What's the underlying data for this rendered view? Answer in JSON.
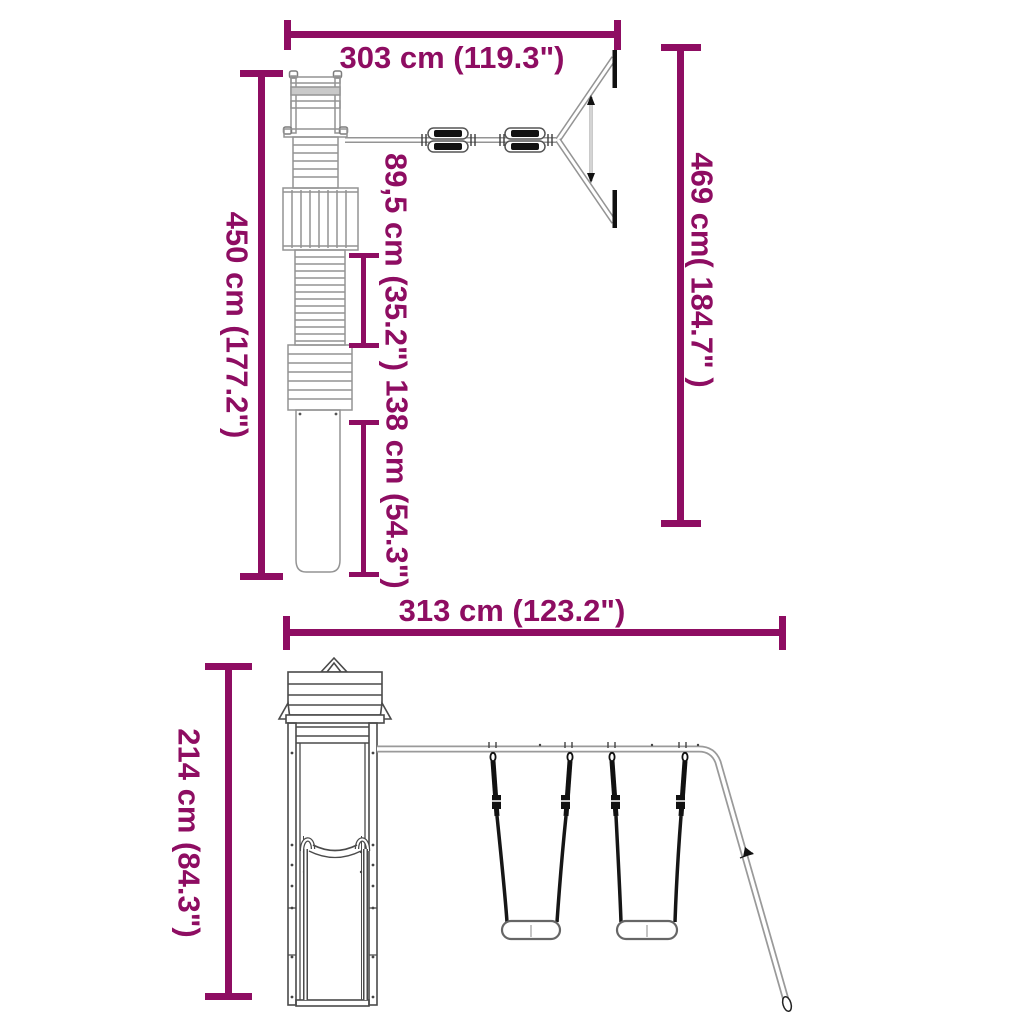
{
  "colors": {
    "dimension_accent": "#8E0D62"
  },
  "plan_view": {
    "width_label": "303 cm (119.3\")",
    "depth_label": "450 cm (177.2\")",
    "platform_depth_label": "89,5 cm (35.2\")",
    "slide_length_label": "138 cm (54.3\")",
    "swing_arm_depth_label": "469 cm( 184.7\" )"
  },
  "front_view": {
    "width_label": "313 cm (123.2\")",
    "height_label": "214 cm (84.3\")"
  }
}
